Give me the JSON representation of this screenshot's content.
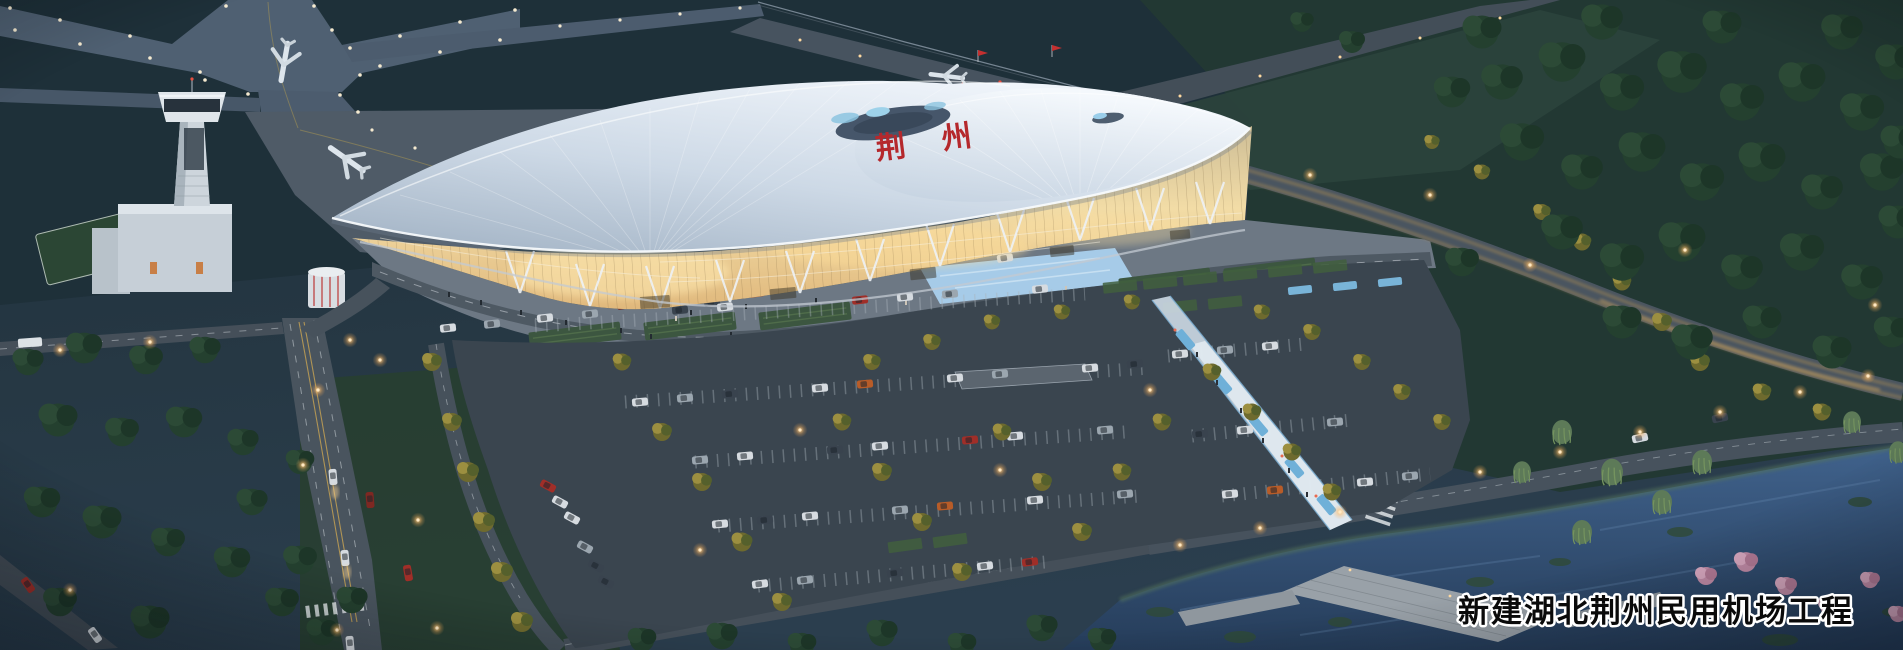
{
  "caption": {
    "text": "新建湖北荆州民用机场工程"
  },
  "sign": {
    "char1": "荆",
    "char2": "州",
    "full": "荆州"
  },
  "palette": {
    "dusk_ground": "#24363f",
    "airfield_grass": "#1e3039",
    "forest_green": "#22382f",
    "taxiway_gray": "#4f6072",
    "apron_gray": "#4f5b67",
    "roof_white": "#e9eef6",
    "facade_glow_warm": "#f2dca6",
    "sign_red": "#b5282c",
    "flag_red": "#c43030",
    "water_blue": "#3a5a82",
    "street_light_amber": "#ffcf7f",
    "taxiway_edge_light": "#f5ead0",
    "tree_lit_yellow": "#9c8f40",
    "blossom_pink": "#d8a8c0",
    "promenade_blue": "#6fb0d8",
    "caption_fill": "#000000",
    "caption_stroke": "#ffffff"
  }
}
